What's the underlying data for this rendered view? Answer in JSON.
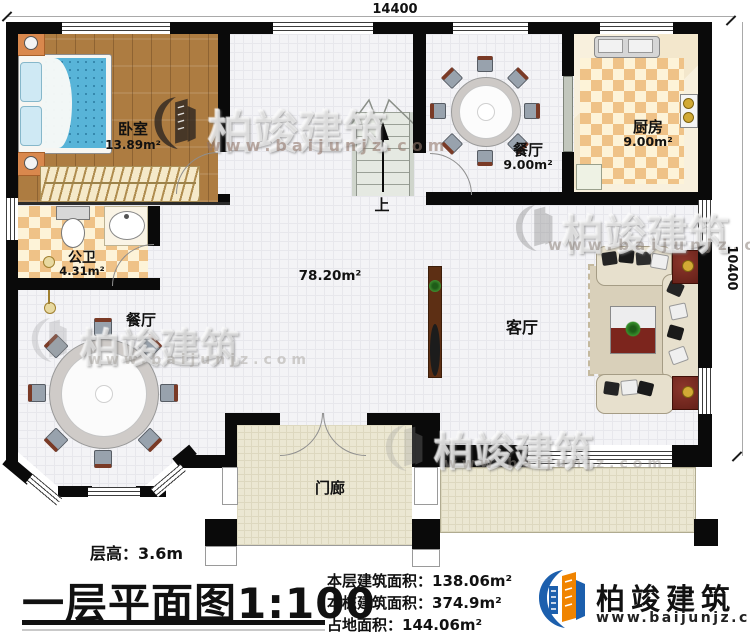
{
  "dimensions": {
    "top": "14400",
    "right": "10400"
  },
  "rooms": {
    "bedroom": {
      "name": "卧室",
      "area": "13.89m²"
    },
    "bathroom": {
      "name": "公卫",
      "area": "4.31m²"
    },
    "dining_upper": {
      "name": "餐厅",
      "area": "9.00m²"
    },
    "kitchen": {
      "name": "厨房",
      "area": "9.00m²"
    },
    "dining_lower": {
      "name": "餐厅"
    },
    "living_room": {
      "name": "客厅"
    },
    "hall_area": "78.20m²",
    "porch": {
      "name": "门廊"
    },
    "stairs": {
      "up_label": "上"
    }
  },
  "watermark": {
    "text": "柏竣建筑",
    "url": "www.baijunjz.com"
  },
  "footer": {
    "floor_height": "层高：3.6m",
    "title": "一层平面图",
    "scale": "1:100",
    "stats": [
      "本层建筑面积：138.06m²",
      "本栋建筑面积：374.9m²",
      "占地面积：144.06m²"
    ],
    "brand": {
      "name": "柏竣建筑",
      "url": "www.baijunjz.com"
    }
  }
}
